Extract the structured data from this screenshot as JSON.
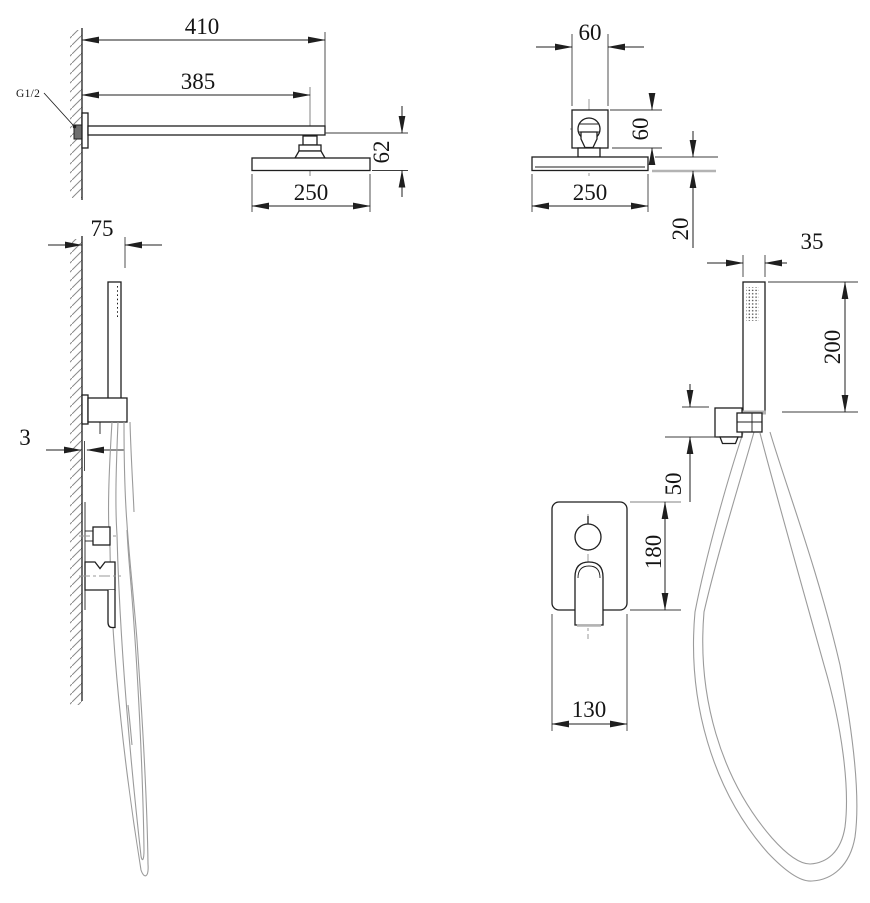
{
  "drawing": {
    "background_color": "#ffffff",
    "line_color": "#1f1f1f",
    "aux_line_color": "#9a9a9a",
    "views": {
      "rain_shower_side": {
        "thread_label": "G1/2",
        "dims": {
          "arm_overall": "410",
          "arm_to_center": "385",
          "head_drop": "62",
          "head_size": "250"
        }
      },
      "rain_shower_front": {
        "dims": {
          "bracket_width": "60",
          "bracket_height": "60",
          "head_size": "250",
          "head_thickness": "20"
        }
      },
      "hand_shower_side": {
        "dims": {
          "holder_depth": "75",
          "plate_offset": "3"
        }
      },
      "hand_shower_front": {
        "dims": {
          "handset_width": "35",
          "handset_length": "200",
          "holder_height": "50",
          "plate_height": "180",
          "plate_width": "130"
        }
      }
    }
  }
}
